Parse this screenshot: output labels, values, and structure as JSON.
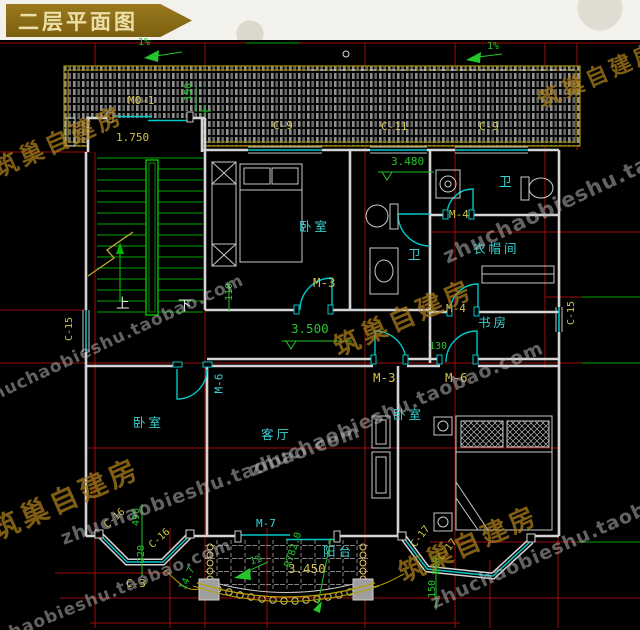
{
  "banner": {
    "title": "二层平面图"
  },
  "watermarks": {
    "site": "zhuchaobieshu.taobao.com",
    "brand": "筑巢自建房"
  },
  "rooms": {
    "bedroom": "卧室",
    "living_room": "客厅",
    "bathroom": "卫",
    "cloakroom": "衣帽间",
    "study": "书房",
    "balcony": "阳台",
    "stairs_up": "上",
    "stairs_down": "下"
  },
  "doors": {
    "m0_1": "MO-1",
    "m3": "M-3",
    "m4": "M-4",
    "m6": "M-6",
    "m7": "M-7"
  },
  "windows": {
    "c3": "C-3",
    "c9": "C-9",
    "c11": "C-11",
    "c15": "C-15",
    "c16": "C-16",
    "c17": "C-17"
  },
  "dimensions": {
    "d1750": "1.750",
    "d3480": "3.480",
    "d3500": "3.500",
    "d3450": "3.450",
    "d490": "490",
    "d220": "220",
    "d150": "150",
    "d130": "130",
    "d110": "110",
    "d147": "14.7",
    "r782": "R782.0",
    "slope": "1%"
  },
  "colors": {
    "wall": "#d4d4d4",
    "window_cyan": "#00c8c8",
    "dimension_green": "#23c42c",
    "label_yellow": "#d2c24a",
    "room_label_cyan": "#3ad2d2",
    "grid_red": "#9e0b0b",
    "grid_green": "#00a800",
    "roof_outline": "#a89000",
    "banner_bg": "#8f6f1d",
    "banner_text": "#ece0a8"
  }
}
